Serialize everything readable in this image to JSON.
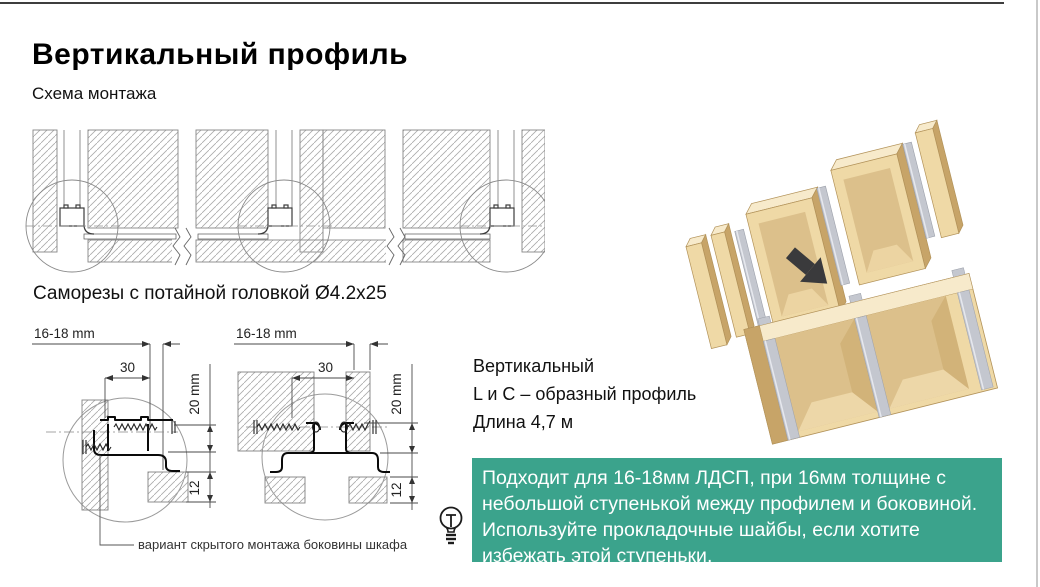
{
  "page": {
    "title": "Вертикальный профиль",
    "subtitle": "Схема монтажа"
  },
  "notes": {
    "screws": "Саморезы с потайной головкой Ø4.2x25",
    "hidden_mount": "вариант скрытого монтажа боковины шкафа"
  },
  "dims": {
    "thickness": "16-18 mm",
    "width": "30",
    "height": "20 mm",
    "depth": "12"
  },
  "profile_info": {
    "line1": "Вертикальный",
    "line2": "L и C – образный профиль",
    "line3": "Длина 4,7 м"
  },
  "tip": {
    "lines": [
      "Подходит для 16-18мм ЛДСП, при 16мм толщине с",
      "небольшой ступенькой между профилем и боковиной.",
      "Используйте прокладочные шайбы, если хотите",
      "избежать этой ступеньки."
    ],
    "background": "#3BA38C",
    "text_color": "#FFFFFF"
  },
  "icons": {
    "tip": "lightbulb-icon"
  },
  "colors": {
    "accent_green": "#3BA38C",
    "wood_face": "#EFD9A6",
    "wood_top": "#F7EACB",
    "wood_side": "#C7A468",
    "wood_inner": "#DCC08B",
    "profile_gray": "#C4C7CF",
    "drawing_line": "#808080",
    "page_rule": "#3D3D3D"
  }
}
